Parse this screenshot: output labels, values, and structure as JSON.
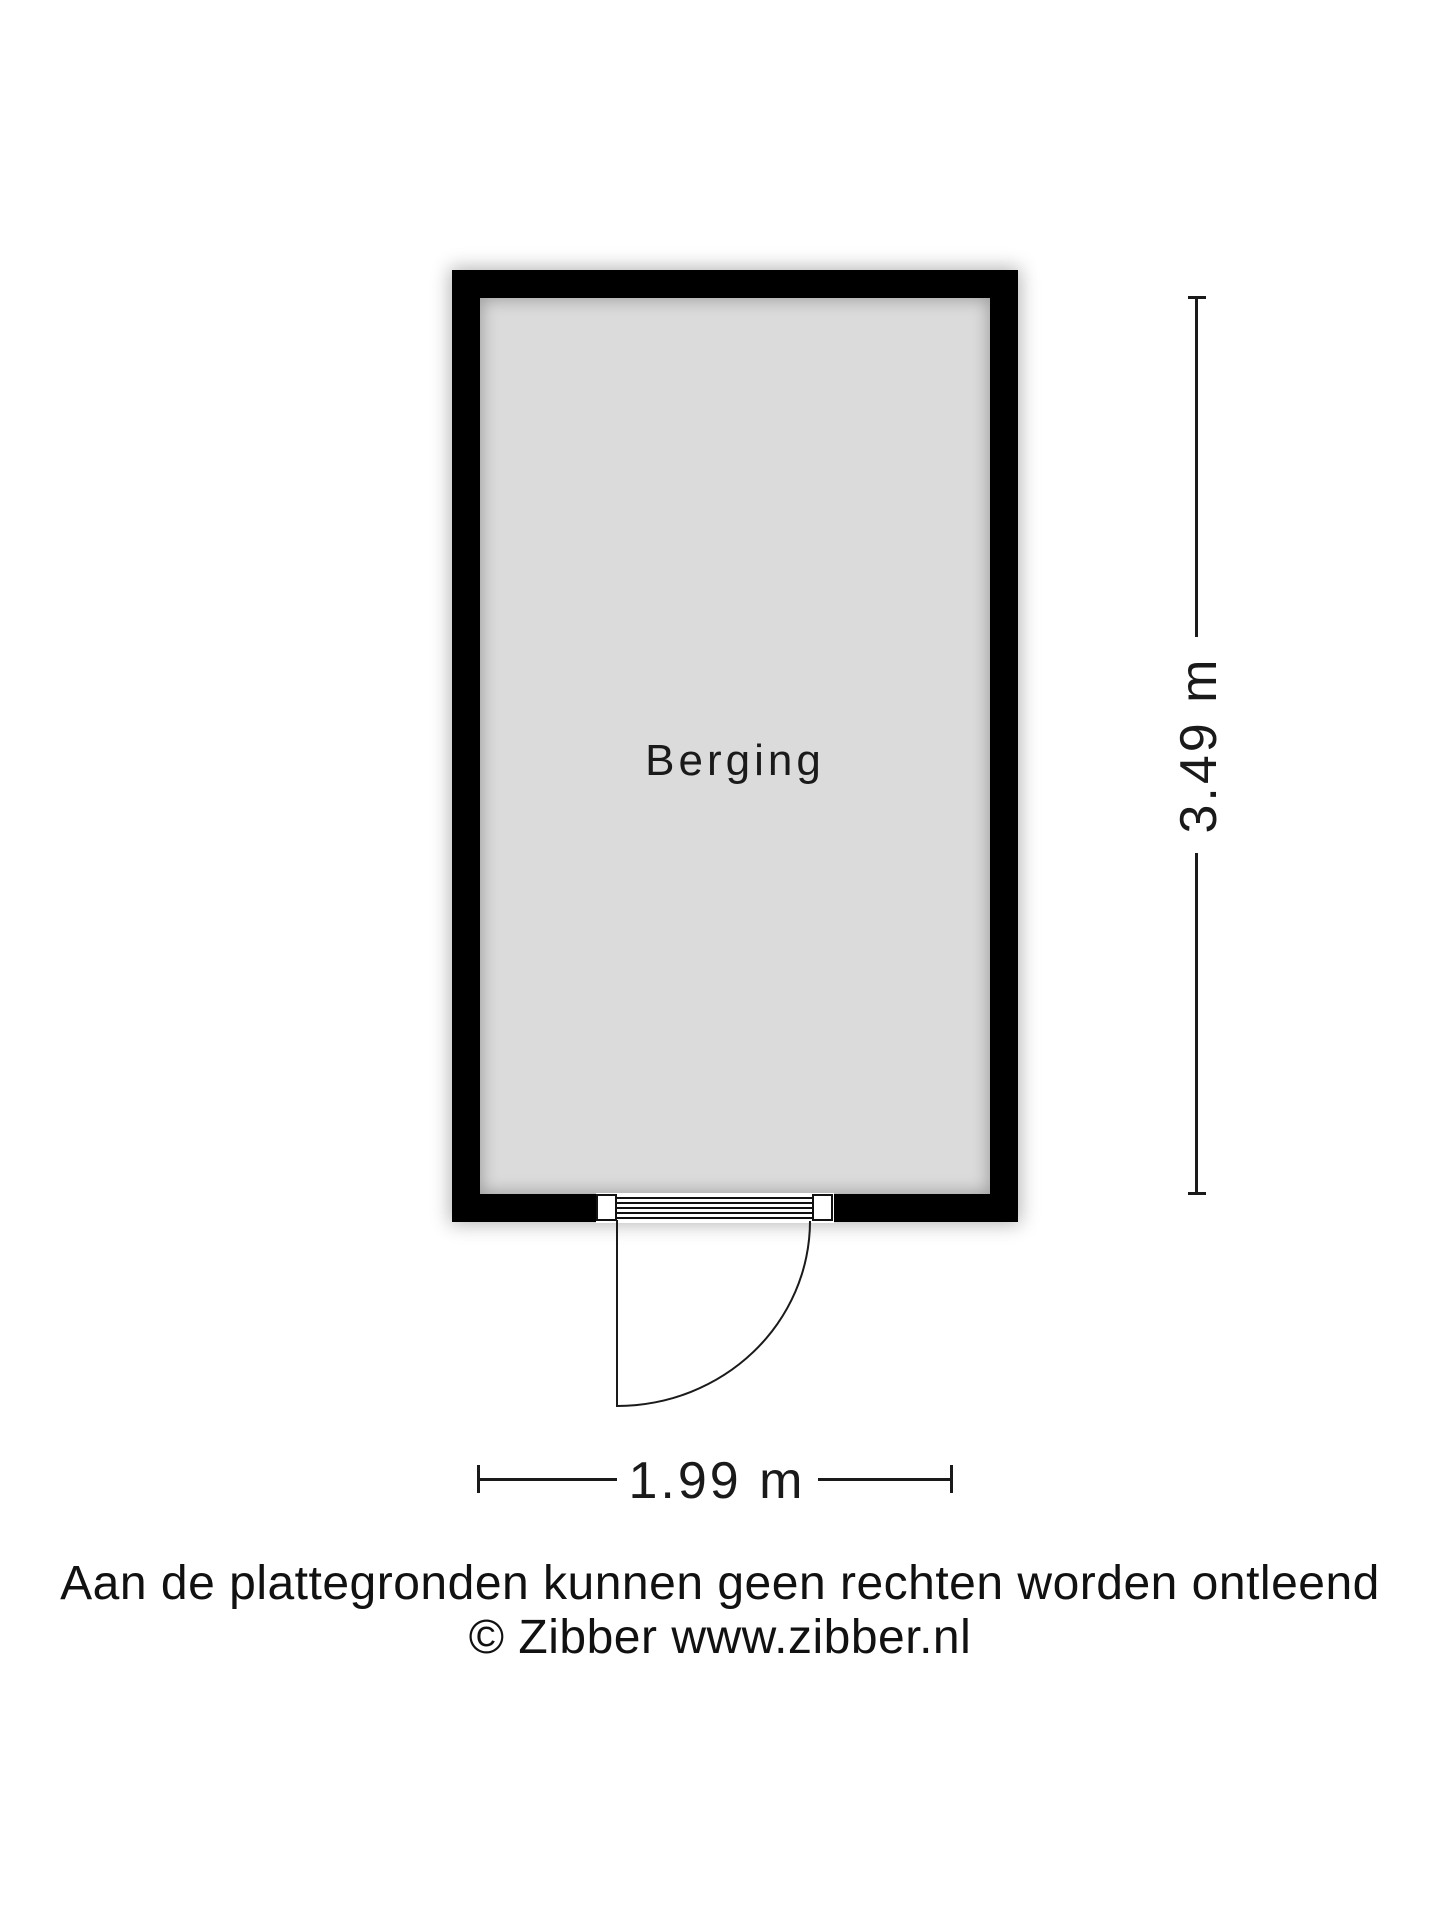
{
  "floorplan": {
    "room": {
      "label": "Berging"
    },
    "dimensions": {
      "width_label": "1.99 m",
      "height_label": "3.49 m"
    },
    "features": [
      "door-bottom-wall-hinged-left-swing-outward"
    ]
  },
  "footer": {
    "disclaimer": "Aan de plattegronden kunnen geen rechten worden ontleend",
    "copyright": "© Zibber www.zibber.nl"
  },
  "colors": {
    "wall": "#000000",
    "floor": "#dbdbdb",
    "line": "#1a1a1a",
    "text": "#1a1a1a",
    "background": "#ffffff"
  }
}
